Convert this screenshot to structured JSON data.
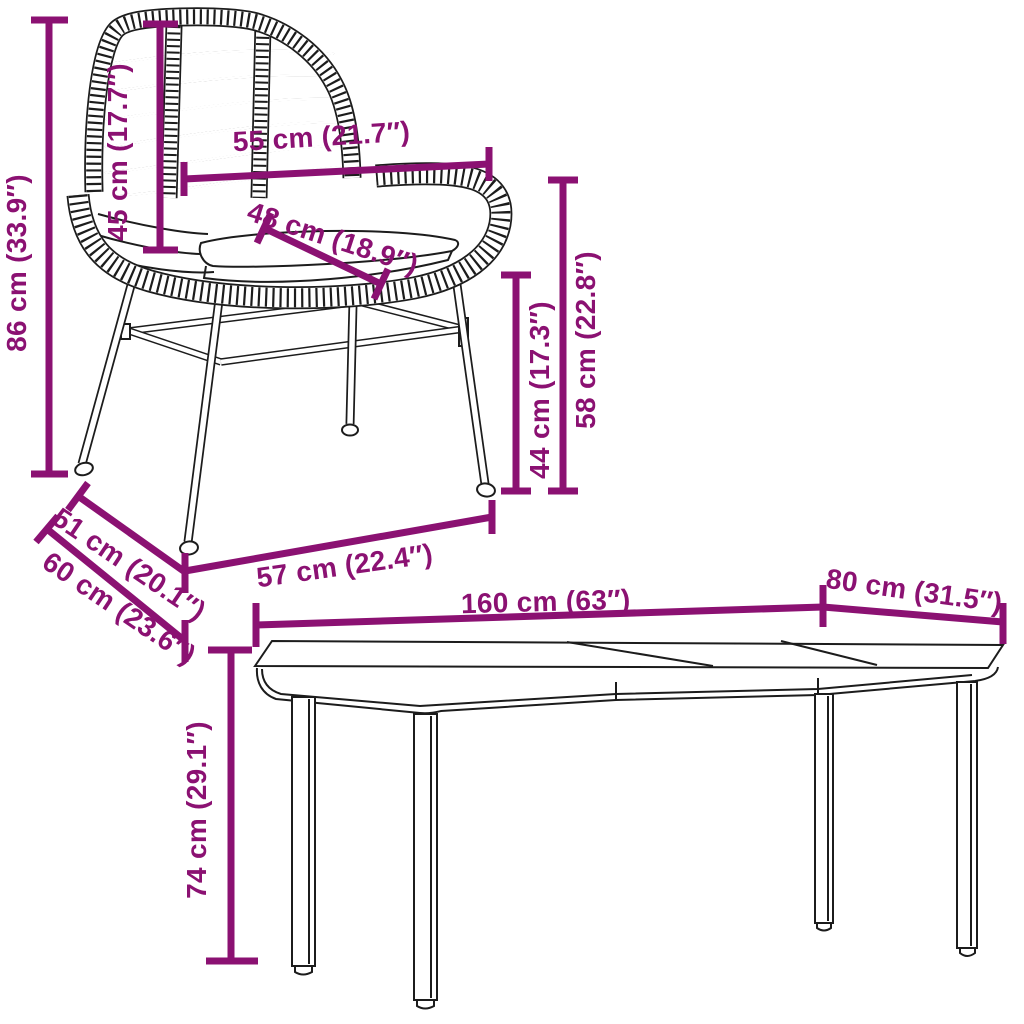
{
  "image": {
    "type": "furniture-dimension-diagram",
    "background": "#ffffff",
    "accent_color": "#8b1172",
    "outline_color": "#1c1c1c"
  },
  "chair": {
    "name": "rattan-garden-chair",
    "dimensions": {
      "height": "86 cm (33.9″)",
      "backrest_height": "45 cm (17.7″)",
      "backrest_width": "55 cm (21.7″)",
      "seat_depth": "48 cm (18.9″)",
      "seat_height": "44 cm (17.3″)",
      "armrest_height": "58 cm (22.8″)",
      "seat_width": "51 cm (20.1″)",
      "depth": "60 cm (23.6″)",
      "width": "57 cm (22.4″)"
    }
  },
  "table": {
    "name": "garden-dining-table",
    "dimensions": {
      "length": "160 cm (63″)",
      "depth": "80 cm (31.5″)",
      "height": "74 cm (29.1″)"
    }
  }
}
